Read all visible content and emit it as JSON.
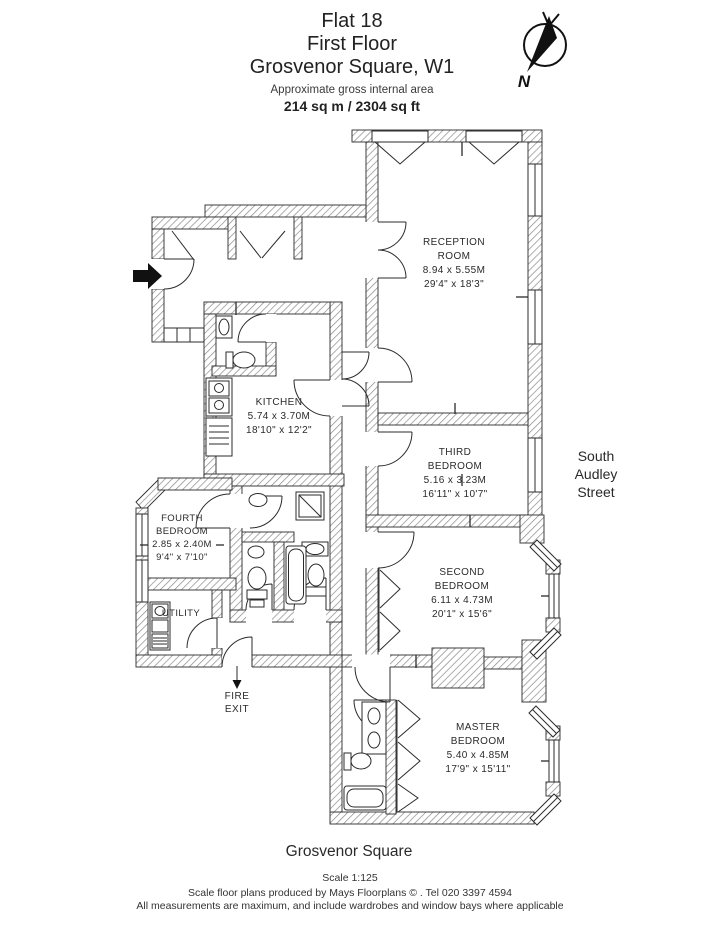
{
  "header": {
    "title_line1": "Flat 18",
    "title_line2": "First Floor",
    "title_line3": "Grosvenor Square, W1",
    "subtitle": "Approximate gross internal area",
    "area": "214 sq m / 2304 sq ft"
  },
  "compass": {
    "north_label": "N"
  },
  "rooms": {
    "reception": {
      "name_line1": "RECEPTION",
      "name_line2": "ROOM",
      "metric": "8.94 x 5.55M",
      "imperial": "29'4\" x 18'3\""
    },
    "third_bedroom": {
      "name_line1": "THIRD",
      "name_line2": "BEDROOM",
      "metric": "5.16 x 3.23M",
      "imperial": "16'11\" x 10'7\""
    },
    "second_bedroom": {
      "name_line1": "SECOND",
      "name_line2": "BEDROOM",
      "metric": "6.11 x 4.73M",
      "imperial": "20'1\" x 15'6\""
    },
    "master_bedroom": {
      "name_line1": "MASTER",
      "name_line2": "BEDROOM",
      "metric": "5.40 x 4.85M",
      "imperial": "17'9\" x 15'11\""
    },
    "kitchen": {
      "name_line1": "KITCHEN",
      "metric": "5.74 x 3.70M",
      "imperial": "18'10\" x 12'2\""
    },
    "fourth_bedroom": {
      "name_line1": "FOURTH",
      "name_line2": "BEDROOM",
      "metric": "2.85 x 2.40M",
      "imperial": "9'4\" x 7'10\""
    },
    "utility": {
      "name_line1": "UTILITY"
    }
  },
  "annotations": {
    "fire_exit_line1": "FIRE",
    "fire_exit_line2": "EXIT",
    "street_line1": "South",
    "street_line2": "Audley",
    "street_line3": "Street",
    "square_label": "Grosvenor Square"
  },
  "footer": {
    "scale": "Scale 1:125",
    "credit": "Scale floor plans produced by Mays Floorplans © . Tel 020 3397 4594",
    "disclaimer": "All measurements are maximum, and include wardrobes and window bays where applicable"
  },
  "colors": {
    "ink": "#1f1f1f",
    "hatch": "#8a8a8a",
    "background": "#ffffff"
  }
}
